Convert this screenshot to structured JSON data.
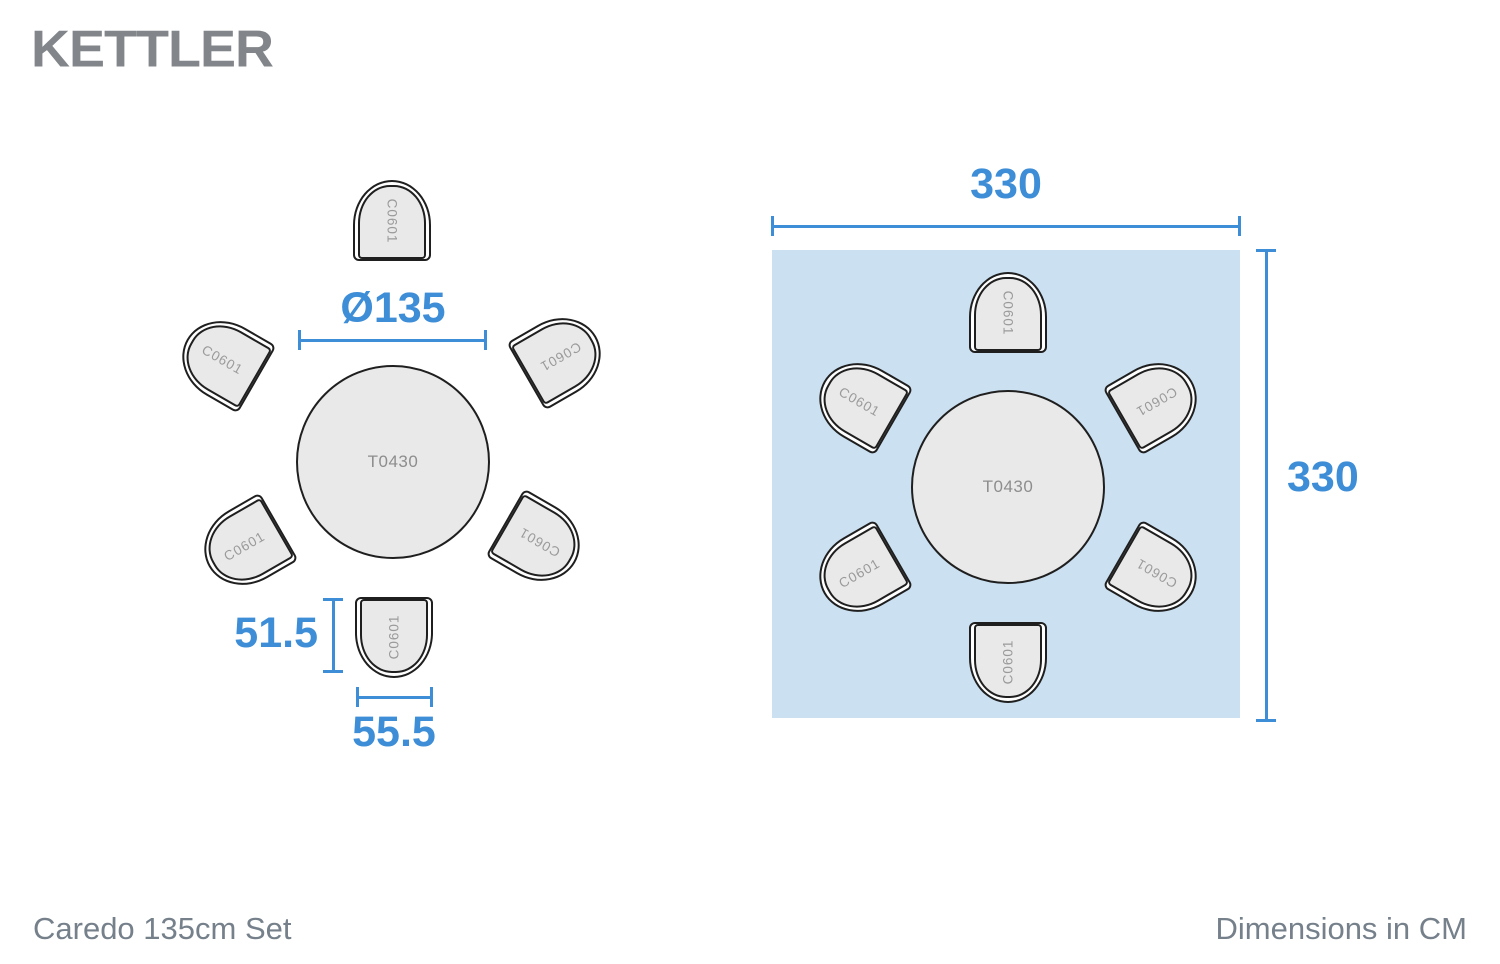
{
  "brand": {
    "name": "KETTLER"
  },
  "footer": {
    "product_title": "Caredo 135cm Set",
    "units_note": "Dimensions in CM"
  },
  "codes": {
    "table": "T0430",
    "chair": "C0601"
  },
  "dimensions": {
    "table_diameter": "Ø135",
    "chair_depth": "51.5",
    "chair_width": "55.5",
    "footprint_width": "330",
    "footprint_height": "330"
  },
  "colors": {
    "dimension_blue": "#3d8dd7",
    "footprint_fill": "#cbe0f1",
    "furniture_fill": "#e9e9e9",
    "outline": "#1f1f1f",
    "logo_gray": "#82868a",
    "footer_gray": "#75808b"
  }
}
